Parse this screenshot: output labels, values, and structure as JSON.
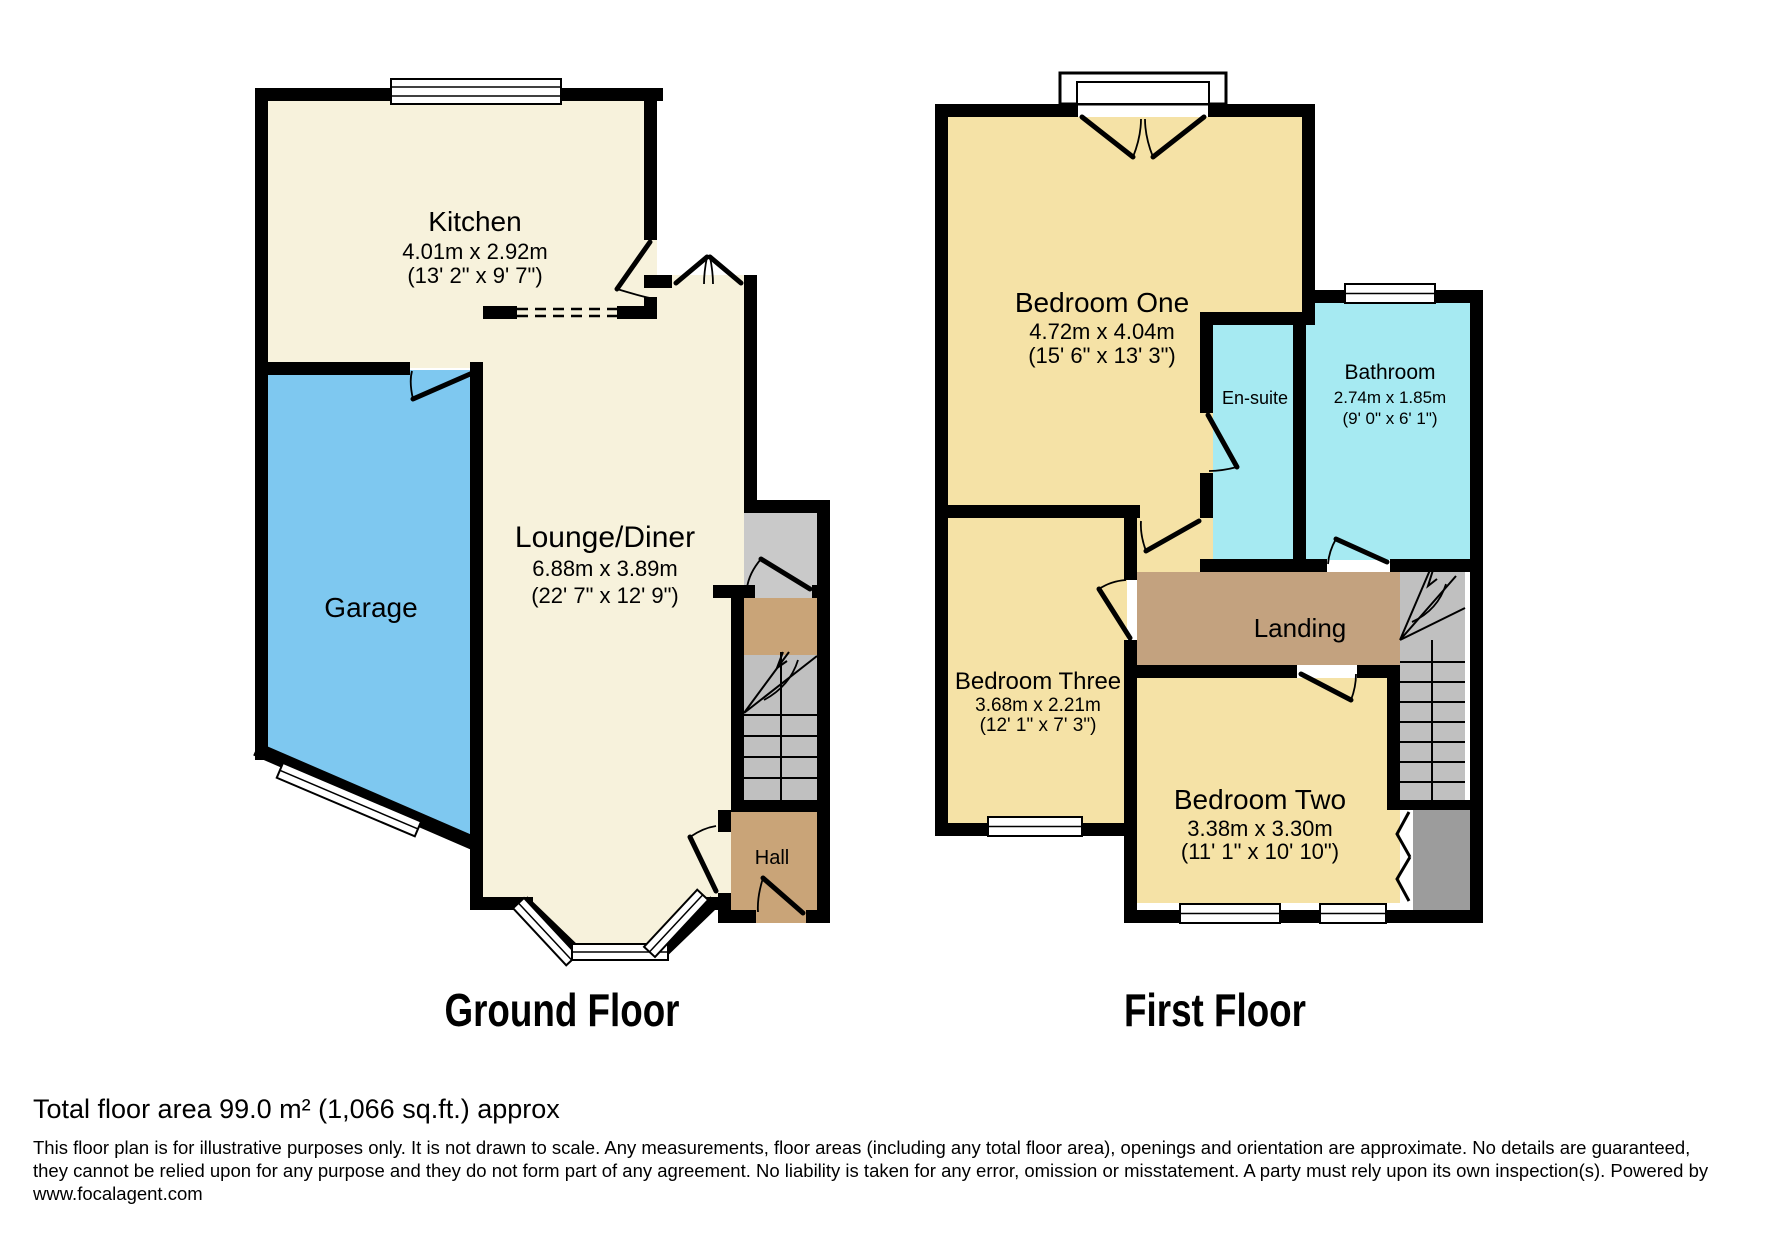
{
  "ground_floor": {
    "title": "Ground Floor",
    "kitchen_name": "Kitchen",
    "kitchen_dims": "4.01m x 2.92m",
    "kitchen_dims_ft": "(13' 2\" x 9' 7\")",
    "garage_name": "Garage",
    "lounge_name": "Lounge/Diner",
    "lounge_dims": "6.88m x 3.89m",
    "lounge_dims_ft": "(22' 7\" x 12' 9\")",
    "hall_name": "Hall"
  },
  "first_floor": {
    "title": "First Floor",
    "bedroom1_name": "Bedroom One",
    "bedroom1_dims": "4.72m x 4.04m",
    "bedroom1_dims_ft": "(15' 6\" x 13' 3\")",
    "ensuite_name": "En-suite",
    "bathroom_name": "Bathroom",
    "bathroom_dims": "2.74m x 1.85m",
    "bathroom_dims_ft": "(9' 0\" x 6' 1\")",
    "landing_name": "Landing",
    "bedroom3_name": "Bedroom Three",
    "bedroom3_dims": "3.68m x 2.21m",
    "bedroom3_dims_ft": "(12' 1\" x 7' 3\")",
    "bedroom2_name": "Bedroom Two",
    "bedroom2_dims": "3.38m x 3.30m",
    "bedroom2_dims_ft": "(11' 1\" x 10' 10\")"
  },
  "footer": {
    "total_area": "Total floor area 99.0 m² (1,066 sq.ft.) approx",
    "disclaimer_line1": "This floor plan is for illustrative purposes only. It is not drawn to scale. Any measurements, floor areas (including any total floor area), openings and orientation are approximate. No details are guaranteed,",
    "disclaimer_line2": "they cannot be relied upon for any purpose and they do not form part of any agreement. No liability is taken for any error, omission or misstatement. A party must rely upon its own inspection(s). Powered by",
    "disclaimer_line3": "www.focalagent.com"
  },
  "colors": {
    "wall": "#000000",
    "cream": "#F7F2DC",
    "bedroom_yellow": "#F5E2A6",
    "garage_blue": "#7EC8F0",
    "bath_cyan": "#A6EAF2",
    "hall_tan": "#C9A478",
    "landing_tan": "#C3A27F",
    "store_gray": "#C9C9C9",
    "stair_gray": "#C0C0C0",
    "storage_dark_gray": "#9C9C9C"
  }
}
